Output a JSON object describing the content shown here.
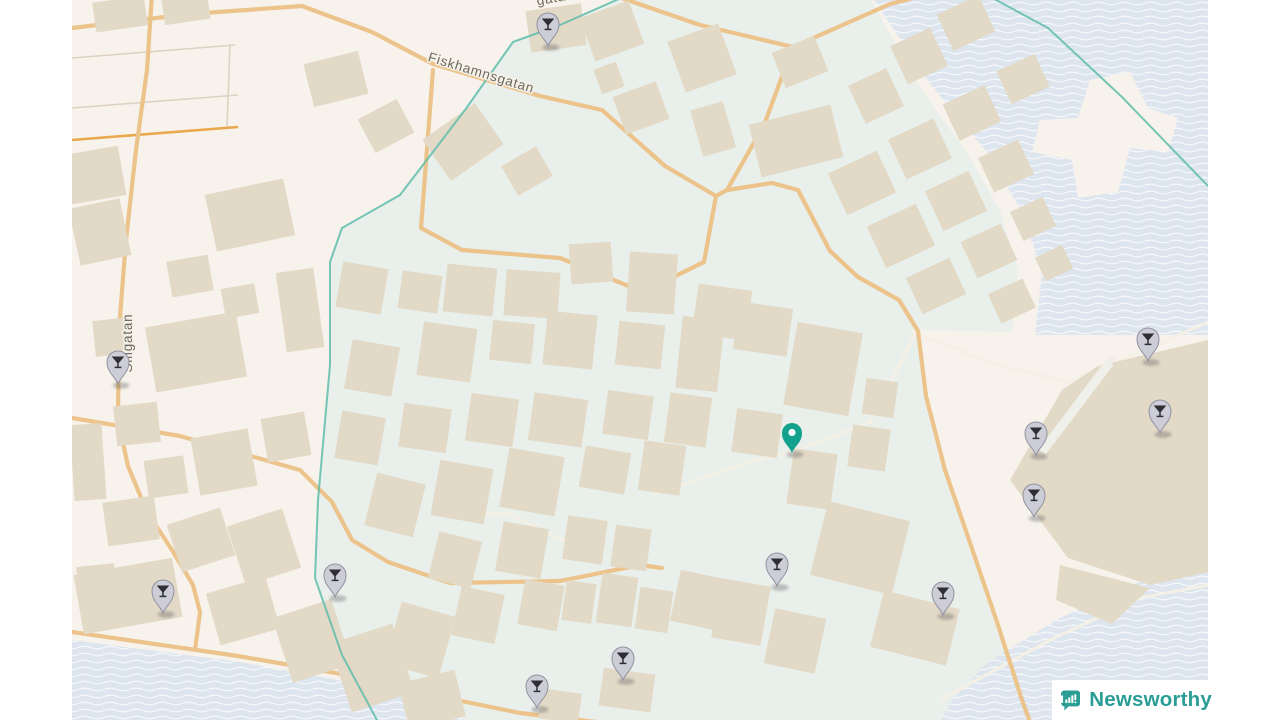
{
  "brand": {
    "name": "Newsworthy",
    "accent": "#2A9D94"
  },
  "map": {
    "street_labels": [
      {
        "name": "Fiskhamnsgatan",
        "x": 480,
        "y": 77,
        "rotation": 17
      },
      {
        "name": "Sillgatan",
        "x": 132,
        "y": 343,
        "rotation": -90
      },
      {
        "name": "gatan",
        "x": 556,
        "y": 2,
        "rotation": -10,
        "partial": true
      }
    ],
    "markers": {
      "venue_icon": "martini-glass",
      "venues": [
        [
          548,
          24
        ],
        [
          118,
          362
        ],
        [
          1148,
          339
        ],
        [
          1160,
          411
        ],
        [
          1036,
          433
        ],
        [
          1034,
          495
        ],
        [
          335,
          575
        ],
        [
          163,
          591
        ],
        [
          777,
          564
        ],
        [
          943,
          593
        ],
        [
          623,
          658
        ],
        [
          537,
          686
        ]
      ],
      "target": {
        "x": 792,
        "y": 433
      }
    },
    "colors": {
      "land": "#F7F3EC",
      "district": "#E9EFEA",
      "water": "#DDE5EE",
      "building": "#E2D9C6",
      "road": "#ECC38B",
      "boundary": "#5FBCAB",
      "pin_gray": "#CDCDD7",
      "pin_teal": "#12A18C"
    }
  }
}
